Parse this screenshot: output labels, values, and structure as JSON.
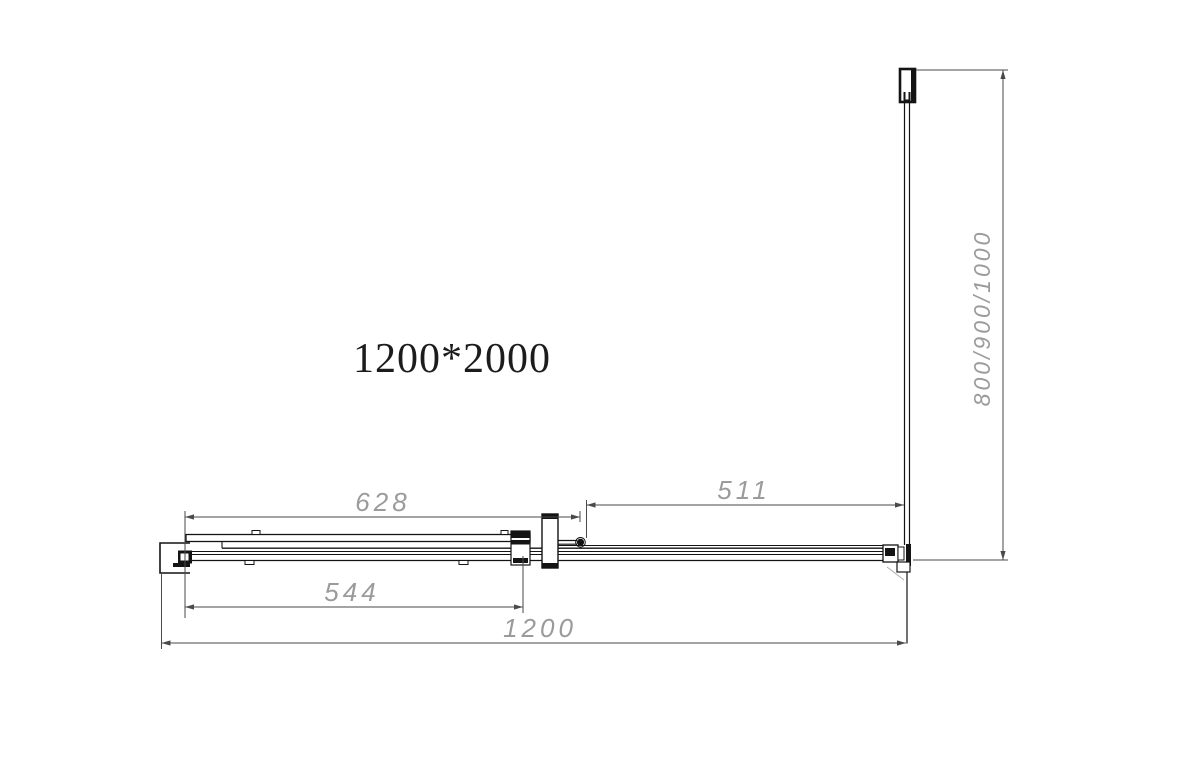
{
  "page": {
    "background": "#ffffff"
  },
  "drawing": {
    "product_size_label": "1200*2000",
    "dims": {
      "top_door": "628",
      "opening": "511",
      "bottom_panel": "544",
      "overall_width": "1200",
      "side_depth": "800/900/1000"
    },
    "colors": {
      "geometry": "#141414",
      "dimension_line": "#4a4a4a",
      "dimension_text": "#9b9b9b"
    }
  }
}
